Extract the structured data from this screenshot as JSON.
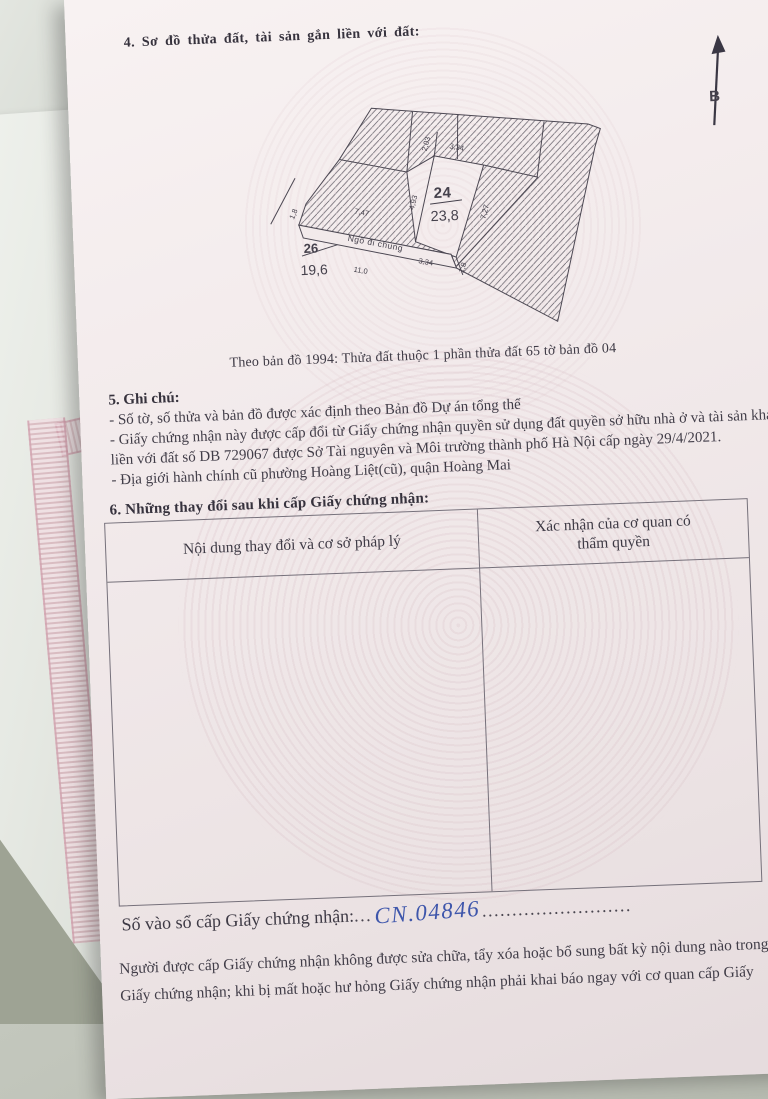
{
  "colors": {
    "paper": "#f2eaeb",
    "ink": "#413d48",
    "table_border": "#76717b",
    "handwriting_blue": "#3e56ab",
    "cable_dark": "#3f4a55",
    "pink_certificate_border": "#cb8a9c"
  },
  "section4": {
    "heading": "4. Sơ đồ thửa đất, tài sản gắn liền với đất:"
  },
  "compass": {
    "north_label": "B"
  },
  "map": {
    "plots": [
      {
        "number": "24",
        "area": "23,8"
      },
      {
        "number": "26",
        "area": "19,6"
      }
    ],
    "alley_label": "Ngõ đi chung",
    "dimensions": {
      "top_334": "3,34",
      "d203": "2,03",
      "d493": "4,93",
      "d747": "7,47",
      "left_18": "1,8",
      "d727": "7,27",
      "bottom_334": "3,34",
      "bottom_18": "1,8",
      "d110": "11,0"
    },
    "caption": "Theo bản đồ 1994: Thửa đất thuộc 1 phần thửa đất 65 tờ bản đồ 04"
  },
  "section5": {
    "heading": "5. Ghi chú:",
    "notes": [
      "- Số tờ, số thửa và bản đồ được xác định theo Bản đồ Dự án tổng thể",
      "- Giấy chứng nhận này được cấp đổi từ Giấy chứng nhận quyền sử dụng đất quyền sở hữu nhà ở và tài sản khác gắn liền với đất số DB 729067 được Sở Tài nguyên và Môi trường thành phố Hà Nội cấp ngày 29/4/2021.",
      "- Địa giới hành chính cũ phường Hoàng Liệt(cũ), quận Hoàng Mai"
    ]
  },
  "section6": {
    "heading": "6. Những thay đổi sau khi cấp Giấy chứng nhận:",
    "table": {
      "col1_header": "Nội dung thay đổi và cơ sở pháp lý",
      "col2_header": "Xác nhận của cơ quan có thẩm quyền"
    }
  },
  "registry": {
    "label": "Số vào sổ cấp Giấy chứng nhận:",
    "dots_before": "...",
    "number": "CN.04846",
    "dots_after": "........................."
  },
  "footer": {
    "line1": "Người được cấp Giấy chứng nhận không được sửa chữa, tẩy xóa hoặc bổ sung bất kỳ nội dung nào trong",
    "line2": "Giấy chứng nhận; khi bị mất hoặc hư hỏng Giấy chứng nhận phải khai báo ngay với cơ quan cấp Giấy"
  }
}
